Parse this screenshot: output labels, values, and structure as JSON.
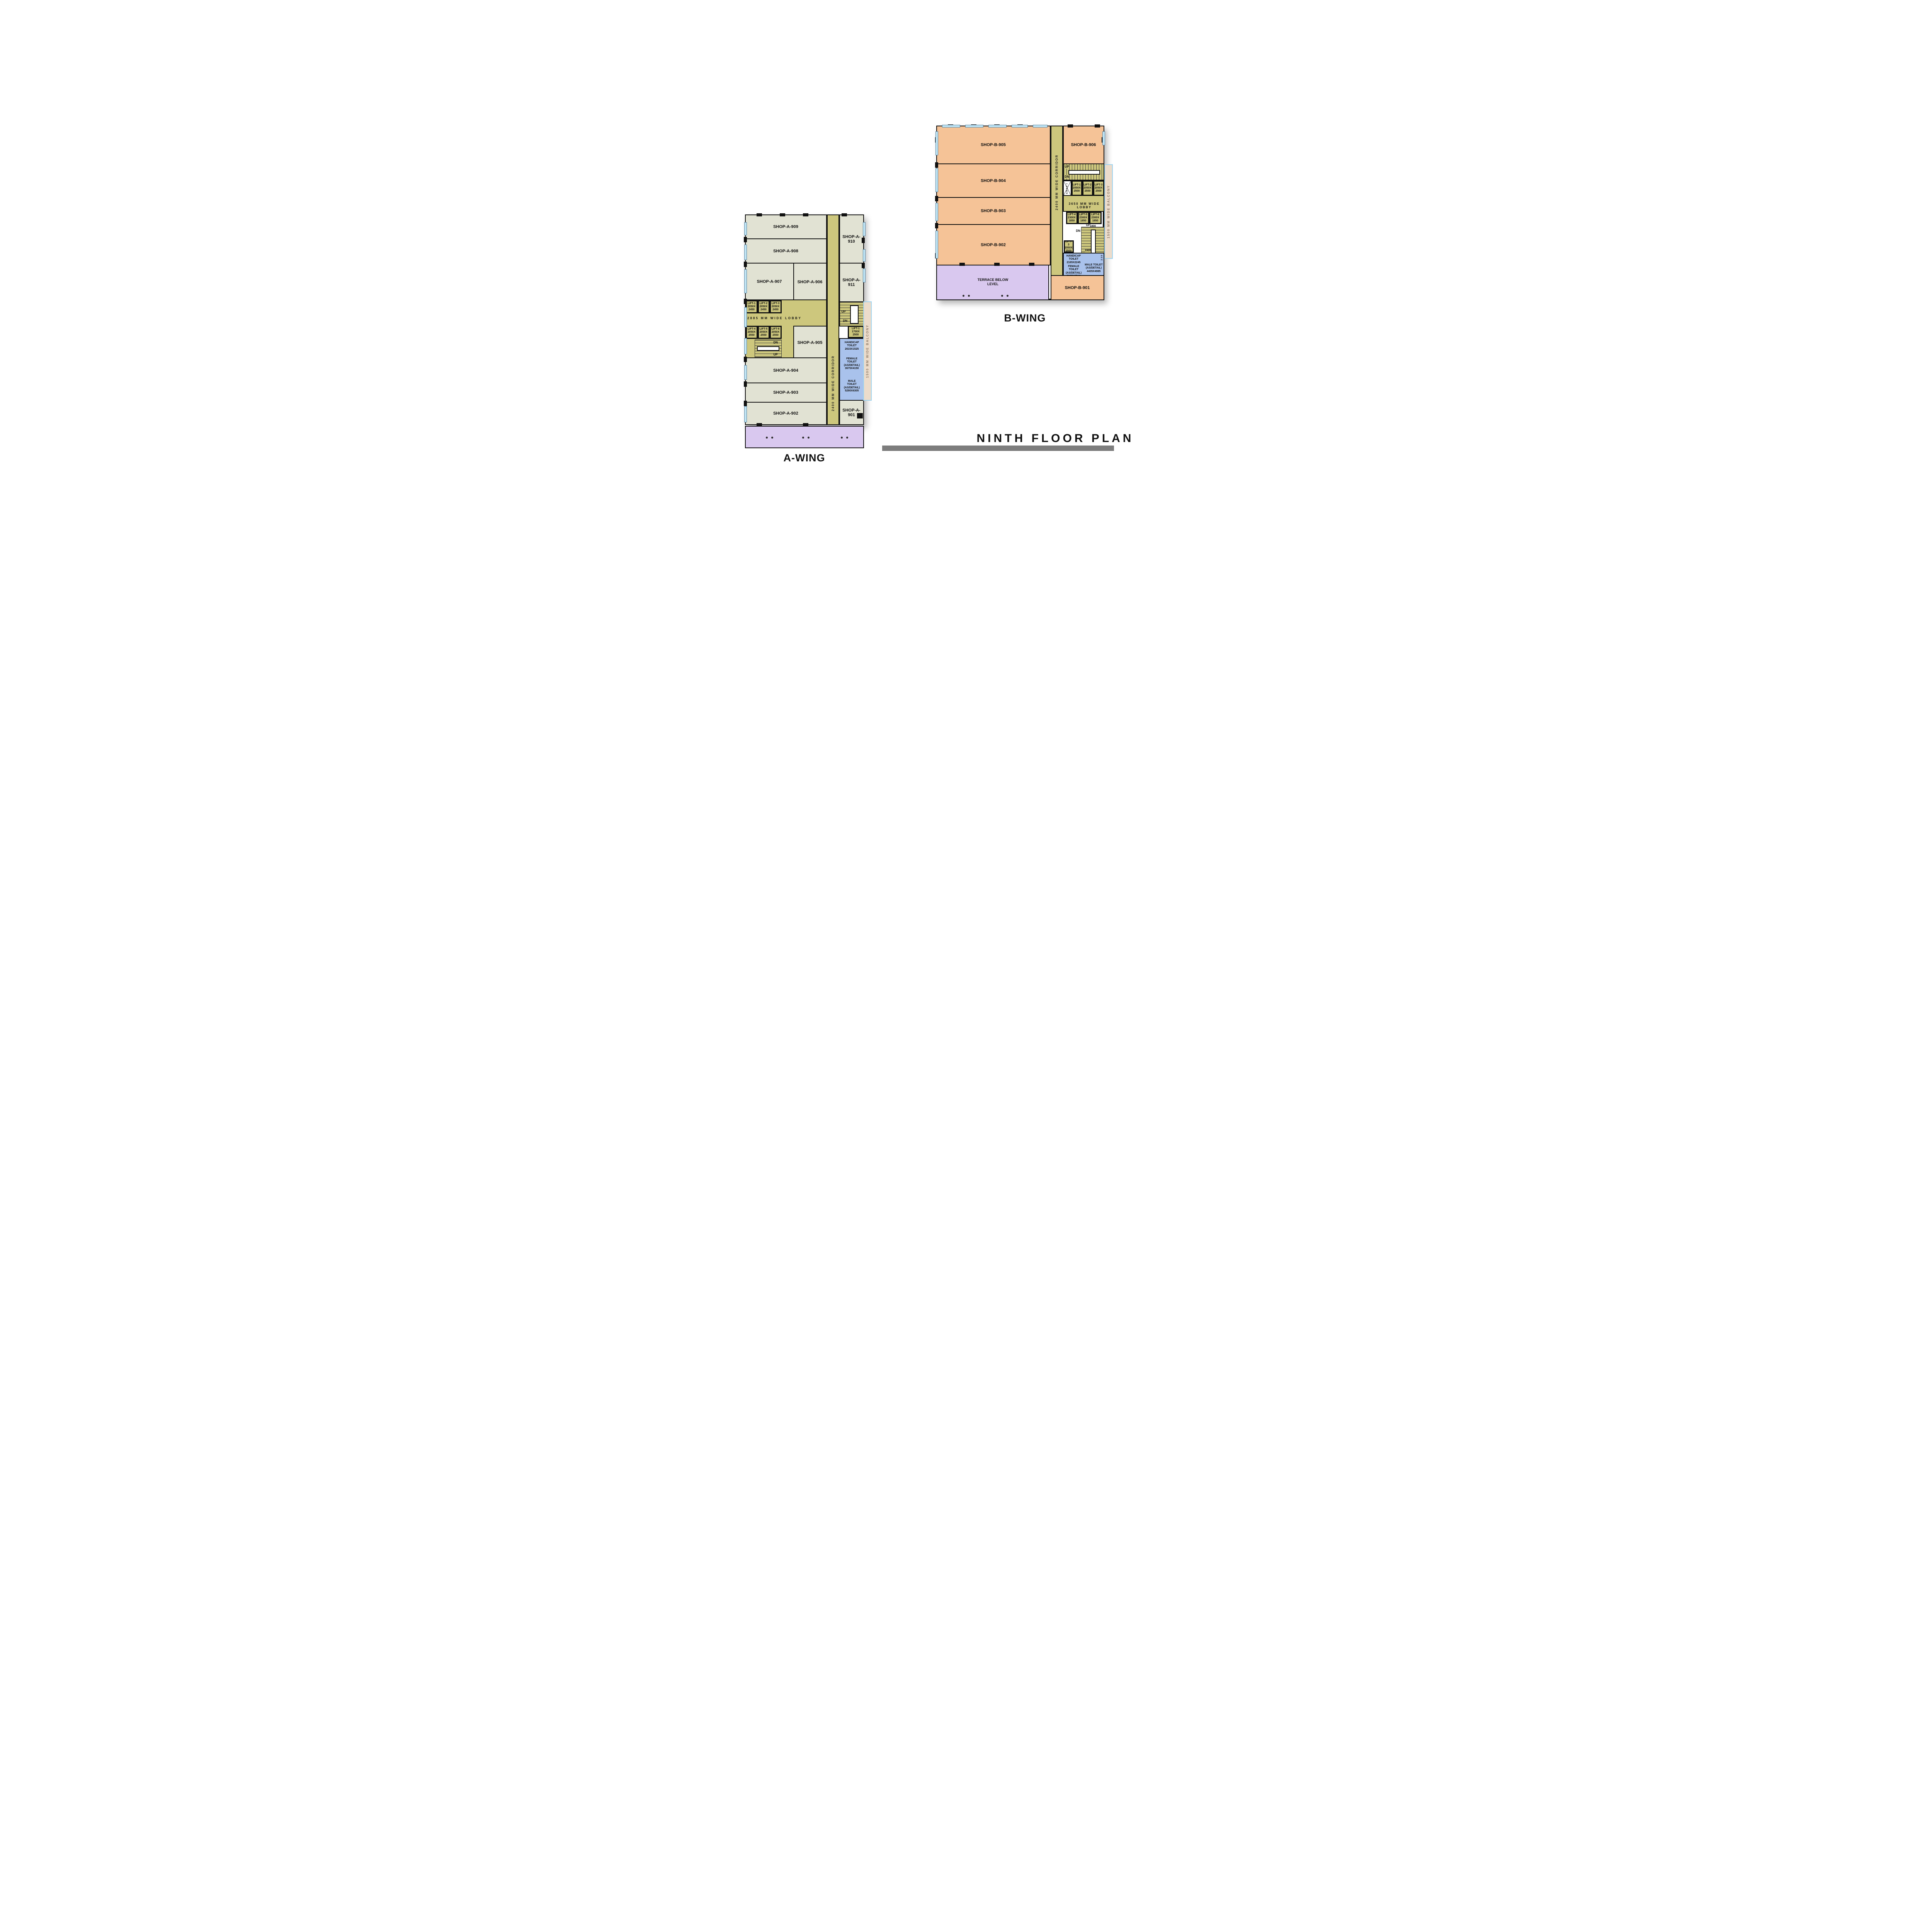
{
  "title": {
    "text": "NINTH FLOOR PLAN"
  },
  "a_wing": {
    "label": "A-WING",
    "corridor": "2400 MM WIDE CORRIDOR",
    "lobby": "2885 MM WIDE LOBBY",
    "balcony": "1500 MM WIDE BALCONY",
    "shops": {
      "s901": "SHOP-A-901",
      "s902": "SHOP-A-902",
      "s903": "SHOP-A-903",
      "s904": "SHOP-A-904",
      "s905": "SHOP-A-905",
      "s906": "SHOP-A-906",
      "s907": "SHOP-A-907",
      "s908": "SHOP-A-908",
      "s909": "SHOP-A-909",
      "s910": "SHOP-A-910",
      "s911": "SHOP-A-911"
    },
    "lifts": {
      "l1": "LIFT-1\n2050X\n2450",
      "l2": "LIFT-2\n2050X\n2450",
      "l3": "LIFT-3\n2050X\n2450",
      "l4": "LIFT-4\n2050X\n2550",
      "l5": "LIFT-5\n2050X\n2550",
      "l6": "LIFT-6\n2050X\n2550",
      "lp1": "LIFT-1\n1700X\n2500"
    },
    "toilets": {
      "handicap": "HANDICAP\nTOILET\n2615X1525",
      "female": "FEMALE\nTOILET\n(AS/DETAIL)\n3675X4150",
      "male": "MALE\nTOILET\n(AS/DETAIL)\n5290X6305"
    },
    "stair": {
      "up": "UP",
      "dn": "DN"
    }
  },
  "b_wing": {
    "label": "B-WING",
    "corridor": "2400 MM WIDE CORRIDOR",
    "lobby": "3650 MM WIDE LOBBY",
    "balcony": "1500 MM WIDE BALCONY",
    "shaft": "SHAFT",
    "terrace": "TERRACE BELOW\nLEVEL",
    "shops": {
      "s901": "SHOP-B-901",
      "s902": "SHOP-B-902",
      "s903": "SHOP-B-903",
      "s904": "SHOP-B-904",
      "s905": "SHOP-B-905",
      "s906": "SHOP-B-906"
    },
    "lifts": {
      "l1": "LIFT-1\n2050X\n2500",
      "l2": "LIFT-2\n2050X\n2500",
      "l3": "LIFT-3\n2050X\n2500",
      "l4": "LIFT-4\n2300X\n1850",
      "l5": "LIFT-5\n2300X\n1850",
      "l6": "LIFT-6\n2300X\n1850",
      "l3b": "LIFT-3\n2050X\n2500"
    },
    "toilets": {
      "handicap": "HANDICAP\nTOILET\n2165X2245",
      "female": "FEMALE\nTOILET\n(AS/DETAIL)\n3865X2740",
      "male": "MALE TOILET\n(AS/DETAIL)\n4435X4985"
    },
    "stair": {
      "up": "UP",
      "dn": "DN"
    },
    "dims": {
      "d1800": "1800",
      "d1920": "1920",
      "d230": "230"
    }
  },
  "colors": {
    "shop_a": "#e1e2d3",
    "shop_b": "#f5c397",
    "corridor": "#cdc77d",
    "toilet": "#a9c2ec",
    "balcony_side": "#ecdccb",
    "balcony_bottom": "#d9c8ef",
    "wall": "#111111",
    "title_bar": "#7d7d7d",
    "window": "#bfe4f4"
  }
}
